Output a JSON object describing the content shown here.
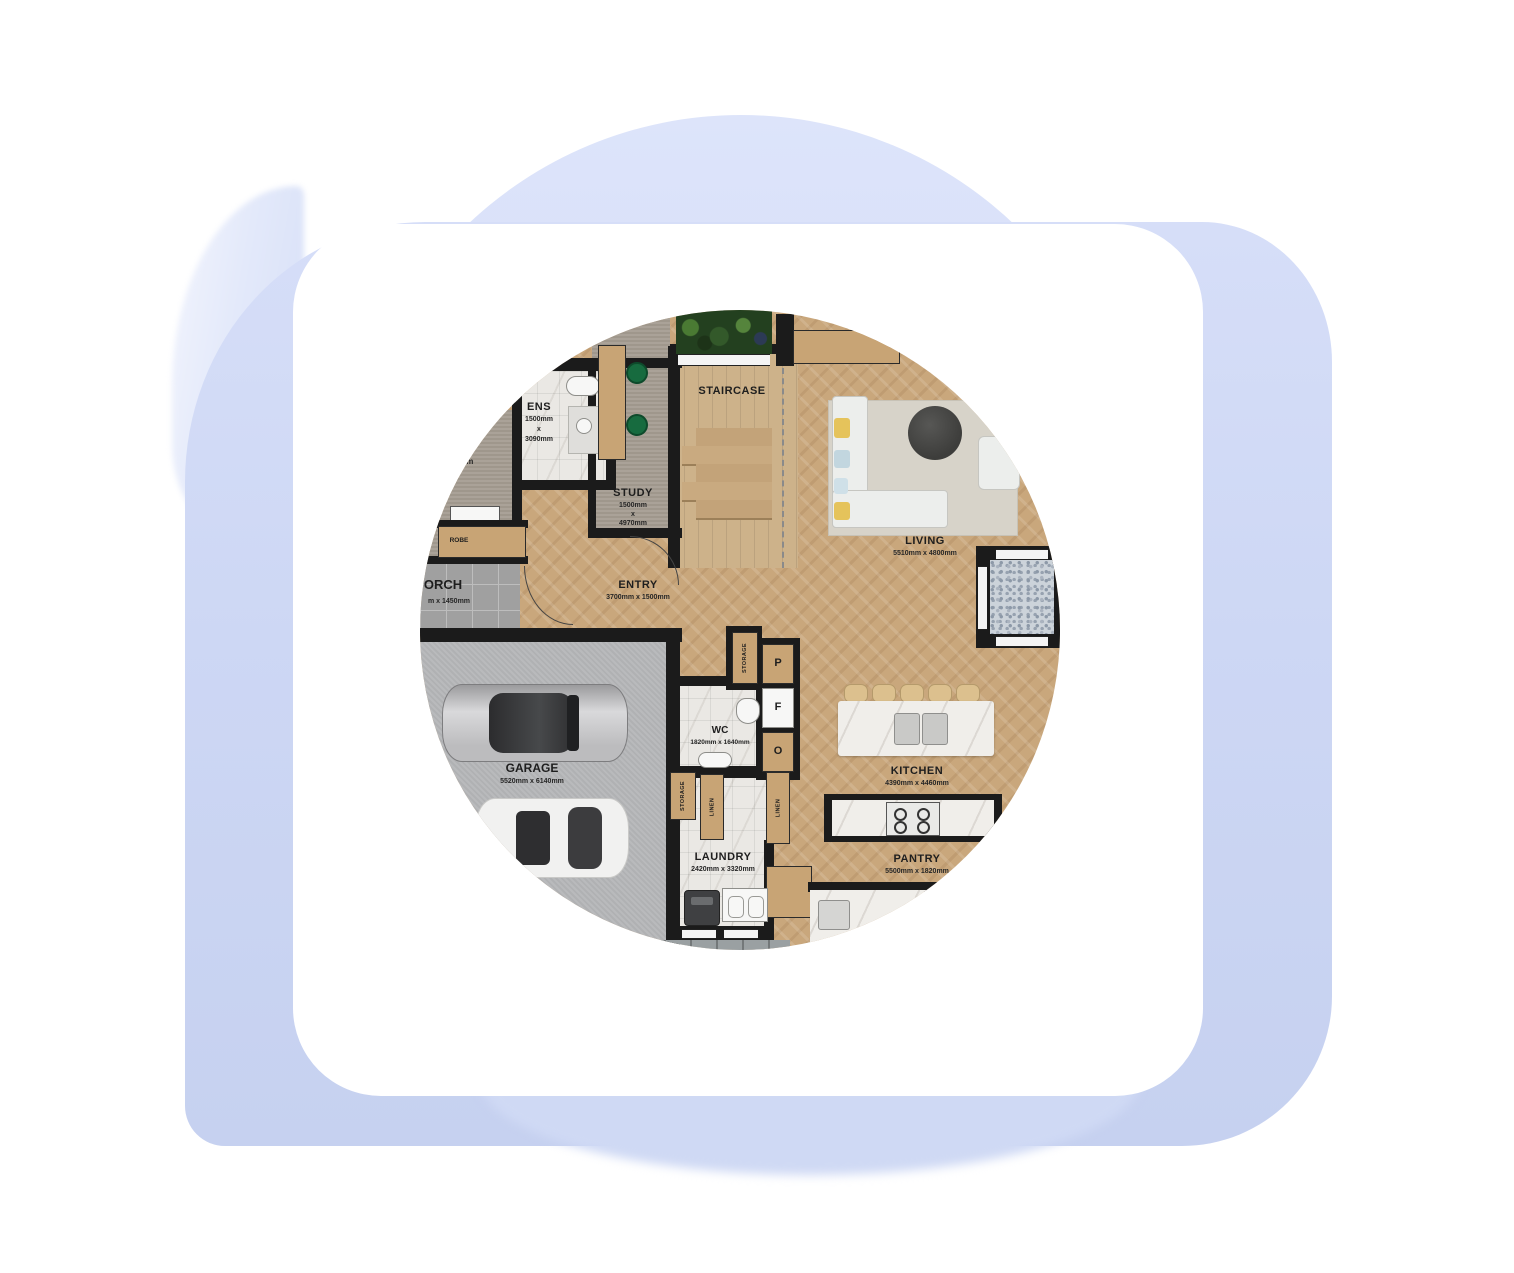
{
  "scene": {
    "background_color": "#ffffff",
    "blob_color": "#ccd7f4",
    "card_color": "#ffffff",
    "image_type": "circular floor plan render on white rounded card over lavender blob"
  },
  "fp": {
    "staircase": {
      "name": "STAIRCASE"
    },
    "ens": {
      "name": "ENS",
      "w": "1500mm",
      "sep": "x",
      "h": "3090mm"
    },
    "study": {
      "name": "STUDY",
      "w": "1500mm",
      "sep": "x",
      "h": "4970mm"
    },
    "living": {
      "name": "LIVING",
      "dims": "5510mm x 4800mm"
    },
    "entry": {
      "name": "ENTRY",
      "dims": "3700mm x 1500mm"
    },
    "porch": {
      "name_visible": "ORCH",
      "dims_visible": "m x 1450mm"
    },
    "robe": {
      "name": "ROBE"
    },
    "bedroom_partial_dim": "0mm",
    "garage": {
      "name": "GARAGE",
      "dims": "5520mm x 6140mm"
    },
    "wc": {
      "name": "WC",
      "dims": "1820mm x 1640mm"
    },
    "kitchen": {
      "name": "KITCHEN",
      "dims": "4390mm x 4460mm"
    },
    "pantry": {
      "name": "PANTRY",
      "dims": "5500mm x 1820mm"
    },
    "laundry": {
      "name": "LAUNDRY",
      "dims": "2420mm x 3320mm"
    },
    "cabinets": {
      "storage_top": "STORAGE",
      "storage_lower": "STORAGE",
      "linen_a": "LINEN",
      "linen_b": "LINEN",
      "p": "P",
      "f": "F",
      "o": "O"
    }
  }
}
